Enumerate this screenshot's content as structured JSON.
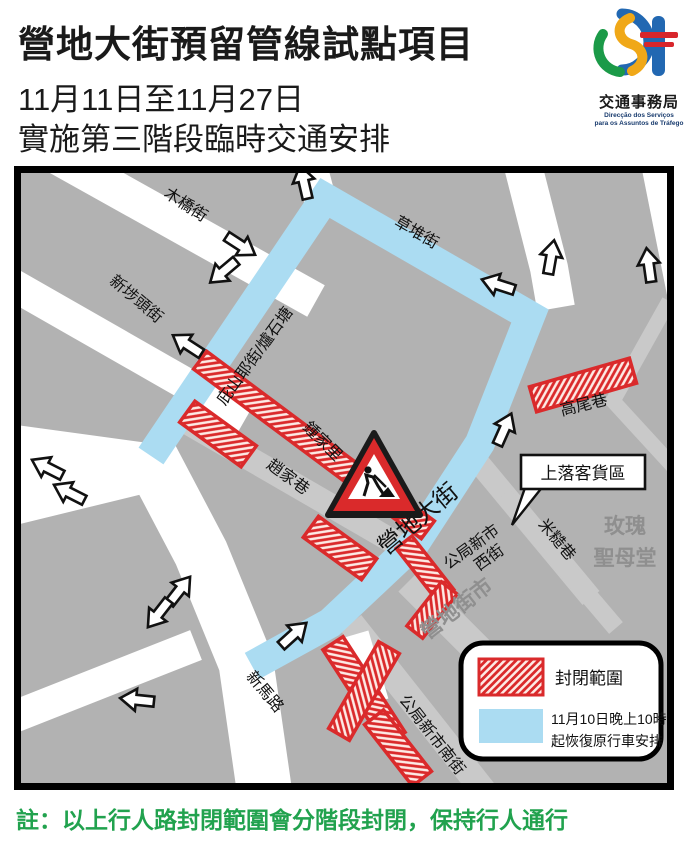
{
  "colors": {
    "route_blue": "#abdcf2",
    "closed_red": "#da2a2b",
    "map_bg": "#b2b2b2",
    "minor_street_gray": "#c9c9c9",
    "note_green": "#21a24e",
    "building_label_gray": "#8f8f8f"
  },
  "header": {
    "title": "營地大街預留管線試點項目",
    "date_line": "11月11日至11月27日",
    "subtitle": "實施第三階段臨時交通安排",
    "logo": {
      "bureau_zh": "交通事務局",
      "bureau_pt_line1": "Direcção dos Serviços",
      "bureau_pt_line2": "para os Assuntos de Tráfego"
    }
  },
  "map": {
    "street_labels": {
      "mu_qiao_jie": "木橋街",
      "xin_bu_tou_jie": "新埗頭街",
      "bi_shan_ye_jie": "庇山耶街/爐石塘",
      "cao_dui_jie": "草堆街",
      "zhong_jia_li": "鍾家里",
      "zhao_jia_xiang": "趙家巷",
      "gao_wei_xiang": "高尾巷",
      "ying_di_da_jie": "營地大街",
      "gong_ju_xin_shi_xi_jie_line1": "公局新市",
      "gong_ju_xin_shi_xi_jie_line2": "西街",
      "mi_cao_xiang": "米糙巷",
      "gong_ju_xin_shi_nan_jie": "公局新市南街",
      "xin_ma_lu": "新馬路"
    },
    "place_labels": {
      "mei_gui_sheng_mu_tang_line1": "玫瑰",
      "mei_gui_sheng_mu_tang_line2": "聖母堂",
      "ying_di_jie_shi": "營地街市"
    },
    "callout_loading_zone": "上落客貨區",
    "legend": {
      "closed_area": "封閉範圍",
      "restore_line1": "11月10日晚上10時",
      "restore_line2": "起恢復原行車安排"
    }
  },
  "footer": {
    "note": "註：以上行人路封閉範圍會分階段封閉，保持行人通行"
  }
}
